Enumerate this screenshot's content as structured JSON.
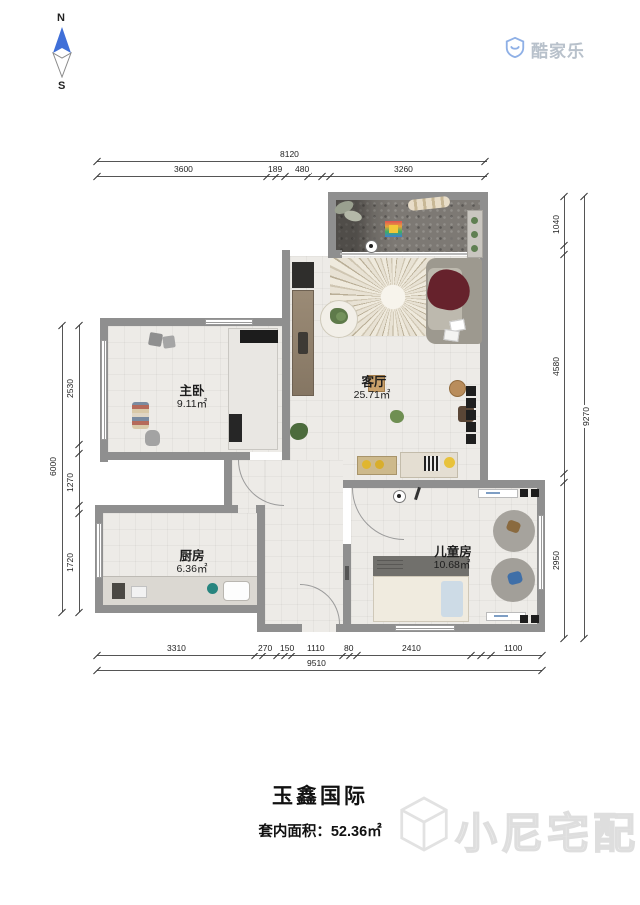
{
  "compass": {
    "north": "N",
    "south": "S"
  },
  "logo": {
    "name": "酷家乐"
  },
  "rooms": {
    "master": {
      "name": "主卧",
      "area": "9.11㎡"
    },
    "living": {
      "name": "客厅",
      "area": "25.71㎡"
    },
    "kitchen": {
      "name": "厨房",
      "area": "6.36㎡"
    },
    "kids": {
      "name": "儿童房",
      "area": "10.68㎡"
    }
  },
  "dimensions": {
    "top": {
      "overall": "8120",
      "segments": [
        "3600",
        "189",
        "480",
        "3260"
      ]
    },
    "left": {
      "overall": "6000",
      "segments": [
        "2530",
        "1270",
        "1720"
      ]
    },
    "right": {
      "overall": "9270",
      "segments": [
        "1040",
        "4580",
        "2950"
      ]
    },
    "bottom": {
      "overall": "9510",
      "segments": [
        "3310",
        "270",
        "150",
        "1110",
        "80",
        "2410",
        "1100"
      ]
    }
  },
  "footer": {
    "title": "玉鑫国际",
    "area_label": "套内面积：",
    "area_value": "52.36㎡"
  },
  "watermark": {
    "text": "小尼宅配"
  },
  "colors": {
    "wall": "#8f8f8f",
    "floor": "#edebe7",
    "balcony": "#7b7671",
    "accent_blue": "#3f6fd8"
  }
}
